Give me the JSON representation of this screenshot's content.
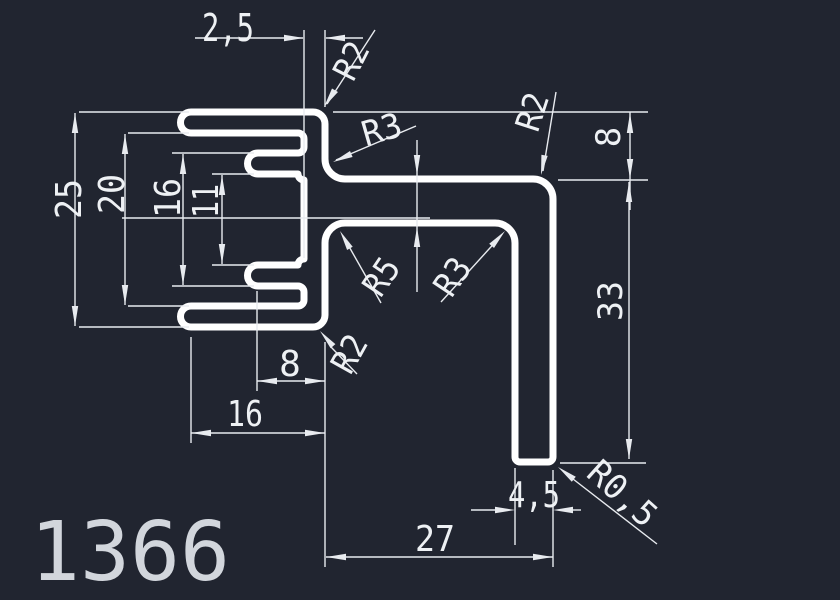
{
  "drawing": {
    "part_number": "1366"
  },
  "colors": {
    "background": "#212530",
    "profile_line": "#ffffff",
    "dimension_line": "#e8ebef",
    "text": "#eef1f4",
    "part_number_text": "#d2d6dc"
  },
  "labels": {
    "thickness": "2,5",
    "r2_top": "R2",
    "r3_top": "R3",
    "r2_arm": "R2",
    "offset8": "8",
    "arm33": "33",
    "r05": "R0,5",
    "foot45": "4,5",
    "width27": "27",
    "r2_bottom": "R2",
    "r5_inner": "R5",
    "r3_inner": "R3",
    "tab8": "8",
    "teeth16": "16",
    "h25": "25",
    "h20": "20",
    "h16": "16",
    "h11": "11",
    "part_number": "1366"
  }
}
